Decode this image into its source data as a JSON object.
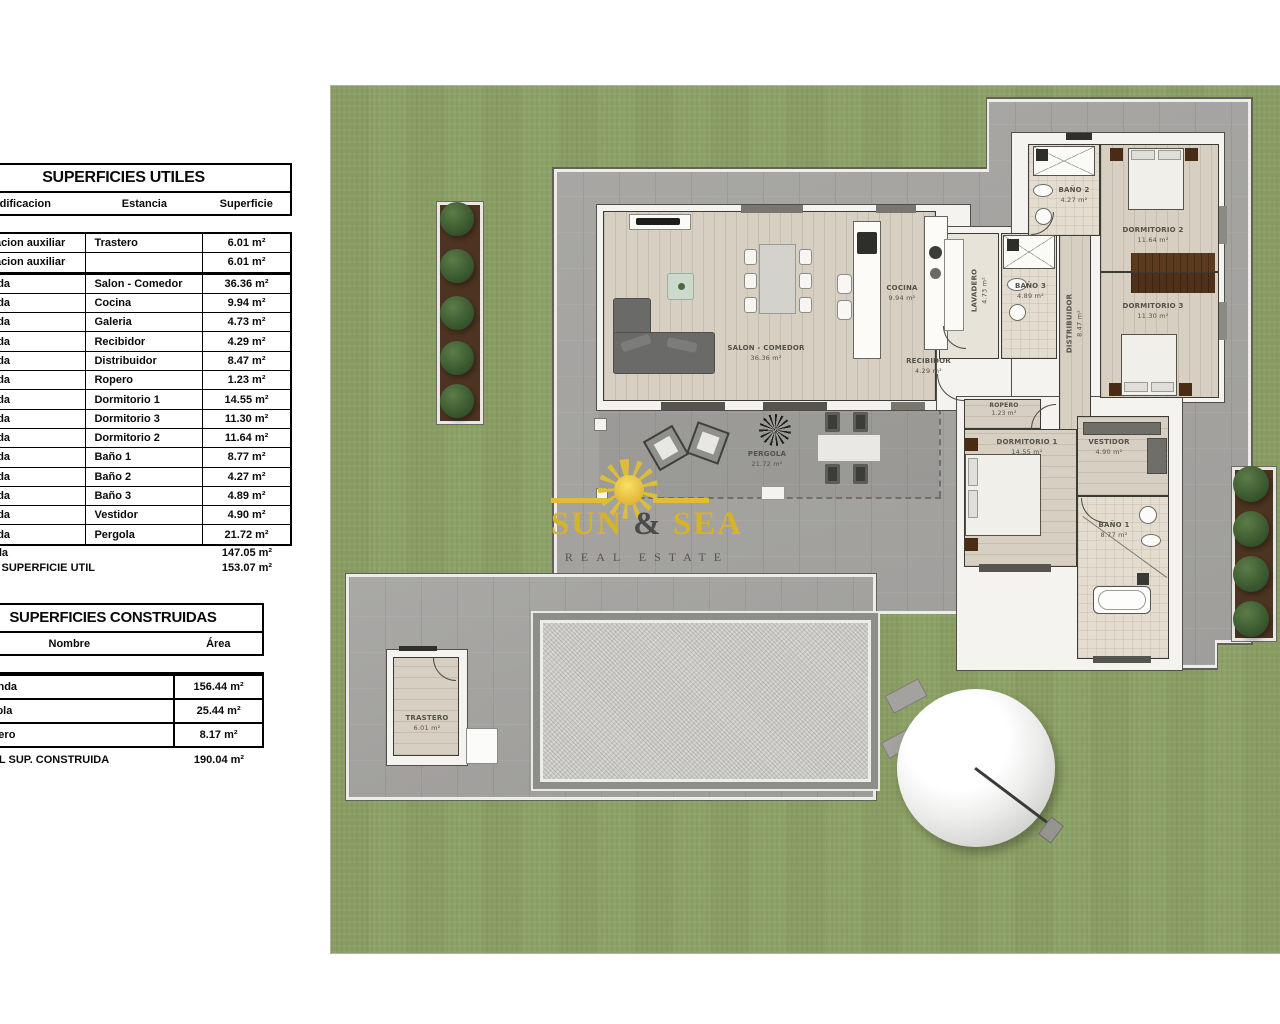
{
  "tables": {
    "utiles": {
      "title": "SUPERFICIES UTILES",
      "columns": [
        "Edificacion",
        "Estancia",
        "Superficie"
      ],
      "rows": [
        [
          "Edificacion auxiliar",
          "Trastero",
          "6.01 m²"
        ],
        [
          "Edificacion auxiliar",
          "",
          "6.01 m²"
        ],
        [
          "Vivienda",
          "Salon - Comedor",
          "36.36 m²"
        ],
        [
          "Vivienda",
          "Cocina",
          "9.94 m²"
        ],
        [
          "Vivienda",
          "Galeria",
          "4.73 m²"
        ],
        [
          "Vivienda",
          "Recibidor",
          "4.29 m²"
        ],
        [
          "Vivienda",
          "Distribuidor",
          "8.47 m²"
        ],
        [
          "Vivienda",
          "Ropero",
          "1.23 m²"
        ],
        [
          "Vivienda",
          "Dormitorio 1",
          "14.55 m²"
        ],
        [
          "Vivienda",
          "Dormitorio 3",
          "11.30 m²"
        ],
        [
          "Vivienda",
          "Dormitorio 2",
          "11.64 m²"
        ],
        [
          "Vivienda",
          "Baño 1",
          "8.77 m²"
        ],
        [
          "Vivienda",
          "Baño 2",
          "4.27 m²"
        ],
        [
          "Vivienda",
          "Baño 3",
          "4.89 m²"
        ],
        [
          "Vivienda",
          "Vestidor",
          "4.90 m²"
        ],
        [
          "Vivienda",
          "Pergola",
          "21.72 m²"
        ]
      ],
      "subtotal": {
        "label": "Vivienda",
        "value": "147.05 m²"
      },
      "total": {
        "label": "TOTAL SUPERFICIE UTIL",
        "value": "153.07 m²"
      }
    },
    "construidas": {
      "title": "SUPERFICIES CONSTRUIDAS",
      "columns": [
        "Nombre",
        "Área"
      ],
      "rows": [
        [
          "Vivienda",
          "156.44 m²"
        ],
        [
          "Pergola",
          "25.44 m²"
        ],
        [
          "Trastero",
          "8.17 m²"
        ]
      ],
      "total": {
        "label": "TOTAL SUP. CONSTRUIDA",
        "value": "190.04 m²"
      }
    }
  },
  "plan": {
    "rooms": {
      "salon": {
        "name": "SALON - COMEDOR",
        "area": "36.36 m²"
      },
      "cocina": {
        "name": "COCINA",
        "area": "9.94 m²"
      },
      "recibidor": {
        "name": "RECIBIDOR",
        "area": "4.29 m²"
      },
      "lavadero": {
        "name": "LAVADERO",
        "area": "4.73 m²"
      },
      "bano3": {
        "name": "BAÑO 3",
        "area": "4.89 m²"
      },
      "distribuidor": {
        "name": "DISTRIBUIDOR",
        "area": "8.47 m²"
      },
      "bano2": {
        "name": "BAÑO 2",
        "area": "4.27 m²"
      },
      "dormitorio2": {
        "name": "DORMITORIO 2",
        "area": "11.64 m²"
      },
      "dormitorio3": {
        "name": "DORMITORIO 3",
        "area": "11.30 m²"
      },
      "ropero": {
        "name": "ROPERO",
        "area": "1.23 m²"
      },
      "dormitorio1": {
        "name": "DORMITORIO 1",
        "area": "14.55 m²"
      },
      "vestidor": {
        "name": "VESTIDOR",
        "area": "4.90 m²"
      },
      "bano1": {
        "name": "BAÑO 1",
        "area": "8.77 m²"
      },
      "pergola": {
        "name": "PERGOLA",
        "area": "21.72 m²"
      },
      "trastero": {
        "name": "TRASTERO",
        "area": "6.01 m²"
      }
    },
    "watermark": {
      "word1": "SUN",
      "amp": "&",
      "word2": "SEA",
      "subtitle": "REAL ESTATE"
    },
    "colors": {
      "grass": "#8da266",
      "terrace": "#a4a3a0",
      "wood_floor": "#d6cfc2",
      "logo_gold": "#d7b32a",
      "tree_green": "#3d5c31",
      "wardrobe_brown": "#5c3a1e",
      "pool_frame": "#8d8d8a"
    }
  }
}
